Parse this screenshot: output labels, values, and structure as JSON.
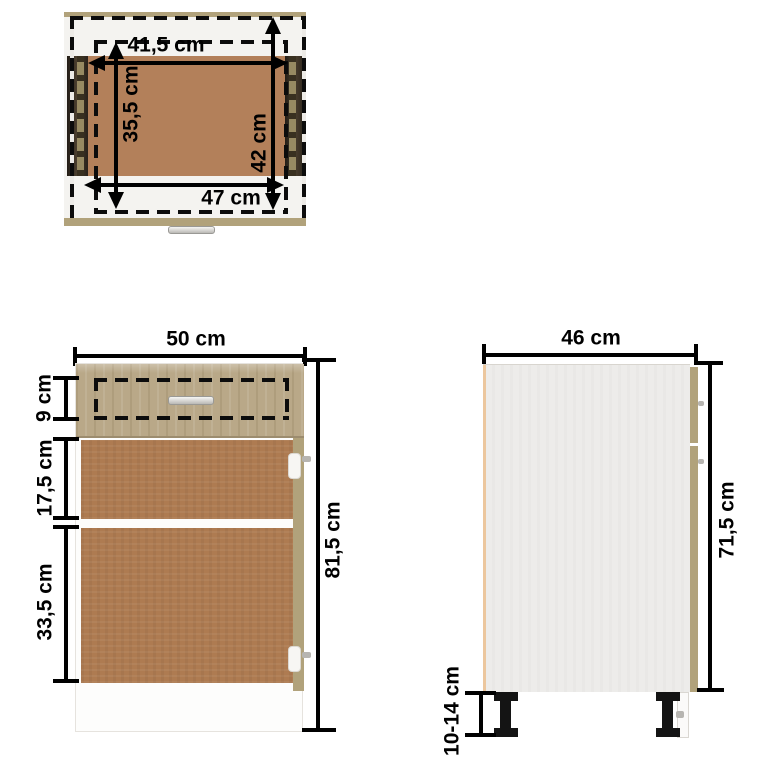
{
  "diagram": {
    "description": "Kitchen base cabinet with drawer – dimension diagram, three views",
    "views": {
      "top_view": {
        "dims": {
          "inner_width": "41,5 cm",
          "inner_depth": "35,5 cm",
          "outer_depth": "42 cm",
          "outer_width": "47 cm"
        }
      },
      "front_view": {
        "dims": {
          "width": "50 cm",
          "drawer_height": "9 cm",
          "upper_door": "17,5 cm",
          "lower_door": "33,5 cm",
          "total_height": "81,5 cm"
        }
      },
      "side_view": {
        "dims": {
          "depth": "46 cm",
          "body_height": "71,5 cm",
          "leg_height": "10-14 cm"
        }
      }
    },
    "colors": {
      "oak_front": "#b9a888",
      "mdf_brown": "#ae7b51",
      "tan_edge": "#b1a27b",
      "dark_rail": "#2e2720",
      "side_panel": "#edecea",
      "dimension_ink": "#000000",
      "handle_silver": "#d6d5d2",
      "leg_black": "#141414"
    }
  }
}
